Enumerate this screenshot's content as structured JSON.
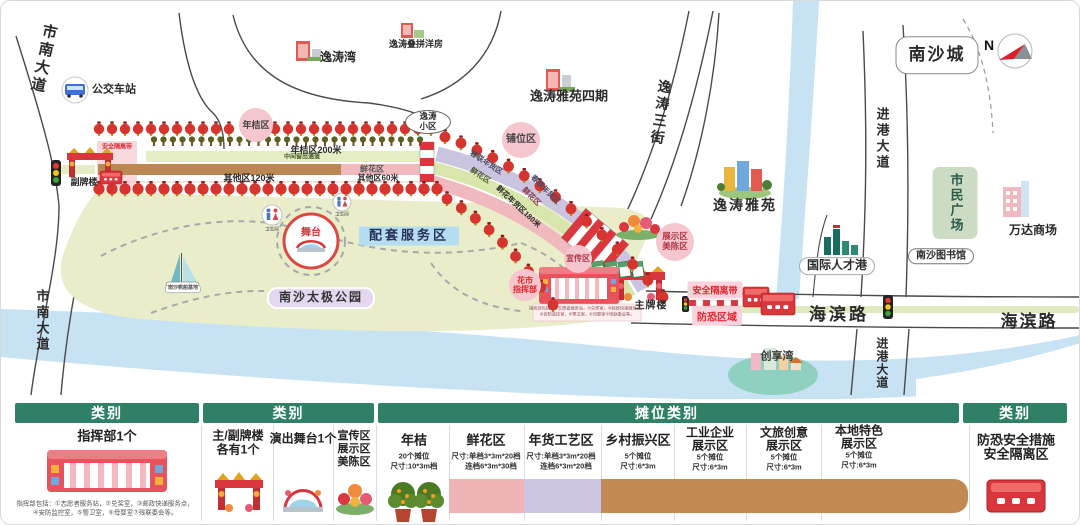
{
  "colors": {
    "header_green": "#2F8066",
    "swatch_pink": "#EEB3B5",
    "swatch_lavender": "#CDC6E2",
    "swatch_tan": "#C28A52",
    "lantern_red": "#D6342E",
    "barrier_red": "#D9363E",
    "park_green": "#E9EDC9",
    "river_blue": "#C7E3F3"
  },
  "map": {
    "compass_n": "N",
    "roads": {
      "shinan_dadao": "市南大道",
      "yitao_sanjie": "逸涛三街",
      "jingang_dadao": "进港大道",
      "haibin_lu": "海滨路"
    },
    "places": {
      "bus_station": "公交车站",
      "yitao_bay": "逸涛湾",
      "yitao_townhouse": "逸涛叠拼洋房",
      "yitao_yayuan_phase4": "逸涛雅苑四期",
      "yitao_xiaoqu_line1": "逸涛",
      "yitao_xiaoqu_line2": "小区",
      "nansha_city": "南沙城",
      "yitao_yayuan": "逸涛雅苑",
      "intl_talent_port": "国际人才港",
      "citizen_plaza": "市民广场",
      "wanda_mall": "万达商场",
      "nansha_library": "南沙图书馆",
      "chuangxiang_bay": "创享湾",
      "taiji_park": "南沙太极公园",
      "sailing_base": "南沙帆船基地",
      "toilet": "卫生间"
    },
    "market": {
      "kumquat_zone": "年桔区",
      "stall_zone": "铺位区",
      "kumquat_200m": "年桔区200米",
      "middle_passage": "中间留出通道",
      "flower_zone": "鲜花区",
      "other_120m": "其他区120米",
      "other_60m": "其他区60米",
      "couplet_goods_zone": "春联年货区",
      "flower_goods_180m": "鲜花年货区180米",
      "support_service_zone": "配套服务区",
      "stage": "舞台",
      "secondary_archway": "副牌楼",
      "main_archway": "主牌楼",
      "safety_belt": "安全隔离带",
      "antiterror_zone": "防恐区域",
      "publicity_zone": "宣传区",
      "display_zone": "展示区",
      "decor_zone": "美陈区",
      "hq_line1": "花市",
      "hq_line2": "指挥部"
    },
    "note_line1": "指挥部包括：①志愿者服务站，②兑奖室，③邮政快递服务点，",
    "note_line2": "④安防监控室，⑤警卫室，⑥母婴室⑦残联委会等。"
  },
  "legend": {
    "headers": {
      "h1": "类别",
      "h2": "类别",
      "h3": "摊位类别",
      "h4": "类别"
    },
    "hq": {
      "title": "指挥部1个"
    },
    "archway": {
      "title": "主/副牌楼",
      "subtitle": "各有1个"
    },
    "stage": {
      "title": "演出舞台1个"
    },
    "zones": {
      "line1": "宣传区",
      "line2": "展示区",
      "line3": "美陈区"
    },
    "stalls": [
      {
        "title": "年桔",
        "line1": "20个摊位",
        "line2": "尺寸:10*3m档"
      },
      {
        "title": "鲜花区",
        "line1": "尺寸:单档3*3m*20档",
        "line2": "连档6*3m*30档"
      },
      {
        "title": "年货工艺区",
        "line1": "尺寸:单档3*3m*20档",
        "line2": "连档6*3m*20档"
      },
      {
        "title": "乡村振兴区",
        "line1": "5个摊位",
        "line2": "尺寸:6*3m"
      },
      {
        "title": "工业企业",
        "title2": "展示区",
        "line1": "5个摊位",
        "line2": "尺寸:6*3m"
      },
      {
        "title": "文旅创意",
        "title2": "展示区",
        "line1": "5个摊位",
        "line2": "尺寸:6*3m"
      },
      {
        "title": "本地特色",
        "title2": "展示区",
        "line1": "5个摊位",
        "line2": "尺寸:6*3m"
      }
    ],
    "security": {
      "line1": "防恐安全措施",
      "line2": "安全隔离区"
    }
  }
}
